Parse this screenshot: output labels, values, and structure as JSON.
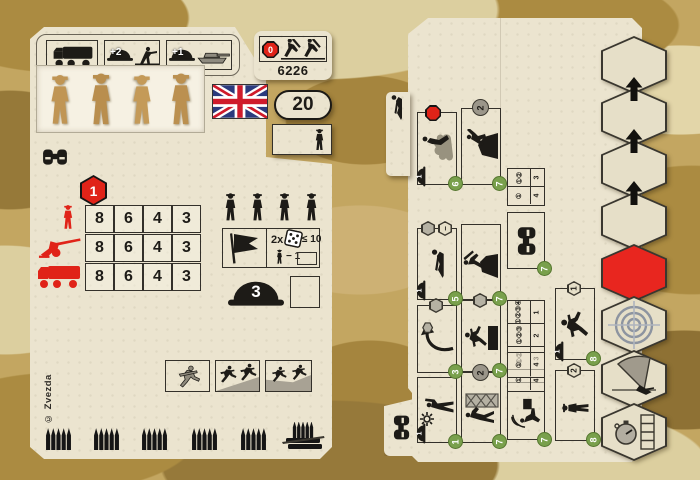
{
  "left_card": {
    "catalog_number": "6226",
    "point_cost": "20",
    "entrench_rating": "0",
    "infantry_defense_bonus": "+2",
    "cover_defense_bonus": "+1",
    "unit_rating": "1",
    "stats": {
      "rows": [
        {
          "target": "infantry",
          "values": [
            "8",
            "6",
            "4",
            "3"
          ]
        },
        {
          "target": "anti-tank-gun",
          "values": [
            "8",
            "6",
            "4",
            "3"
          ]
        },
        {
          "target": "truck",
          "values": [
            "8",
            "6",
            "4",
            "3"
          ]
        }
      ]
    },
    "morale": {
      "multiplier": "2x",
      "threshold": "≤ 10",
      "modifier": "− 1"
    },
    "defense_value": "3",
    "copyright": "© Zvezda"
  },
  "right_card": {
    "orders": {
      "smoke": {
        "helmet": "1",
        "cost": "6"
      },
      "grenade": {
        "badge": "2",
        "cost": "7"
      },
      "spot": {
        "cost": "7"
      },
      "crawl": {
        "badge": "−",
        "helmet": "1",
        "cost": "5"
      },
      "entrench": {
        "cost": "7"
      },
      "maneuver": {
        "cost": "3"
      },
      "assault": {
        "cost": "7"
      },
      "run": {
        "badge": "1",
        "helmet": "1",
        "cost": "8"
      },
      "signal": {
        "helmet": "1",
        "cost": "1"
      },
      "climb": {
        "badge": "2",
        "cost": "7"
      },
      "radio": {
        "cost": "7"
      },
      "march": {
        "badge": "2",
        "cost": "8"
      }
    },
    "range_table_small": {
      "rows": [
        [
          "①②",
          "3"
        ],
        [
          "①",
          "4"
        ]
      ]
    },
    "range_table_large": {
      "rows": [
        [
          "①②③④",
          "1"
        ],
        [
          "①②③",
          "2"
        ],
        [
          "①②",
          "3"
        ],
        [
          "①",
          "4"
        ]
      ]
    },
    "range_table_radio": {
      "rows": [
        [
          "①",
          "4"
        ]
      ]
    }
  }
}
